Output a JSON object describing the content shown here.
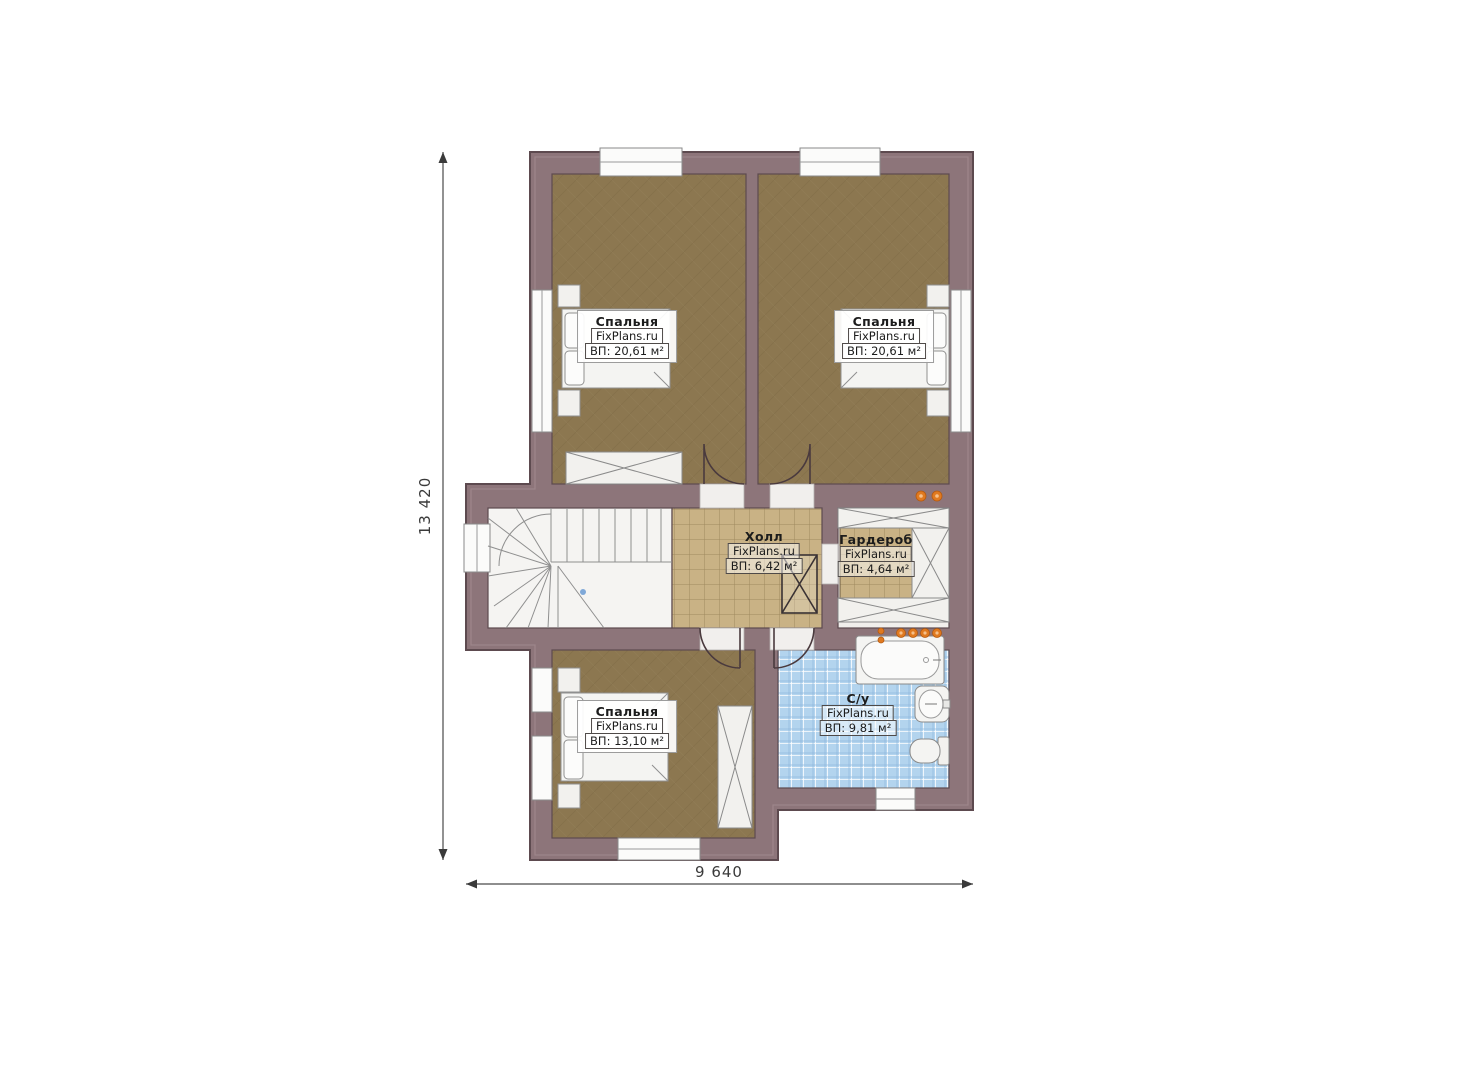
{
  "plan": {
    "brand": "FixPlans.ru",
    "rooms": [
      {
        "id": "bedroom-top-left",
        "name": "Спальня",
        "area": "ВП: 20,61 м²"
      },
      {
        "id": "bedroom-top-right",
        "name": "Спальня",
        "area": "ВП: 20,61 м²"
      },
      {
        "id": "hall",
        "name": "Холл",
        "area": "ВП: 6,42 м²"
      },
      {
        "id": "wardrobe",
        "name": "Гардероб",
        "area": "ВП: 4,64 м²"
      },
      {
        "id": "bedroom-bottom",
        "name": "Спальня",
        "area": "ВП: 13,10 м²"
      },
      {
        "id": "bathroom",
        "name": "С/у",
        "area": "ВП: 9,81 м²"
      }
    ],
    "dimensions": {
      "height": "13 420",
      "width": "9 640"
    },
    "colors": {
      "wall": "#8d757a",
      "wall_outline": "#5d4a4f",
      "wood_floor": "#8c7750",
      "hall_tile": "#c9b285",
      "bath_tile": "#b3d4ee",
      "fixture_white": "#f4f4f2",
      "accent_dots": "#e07a20"
    }
  }
}
